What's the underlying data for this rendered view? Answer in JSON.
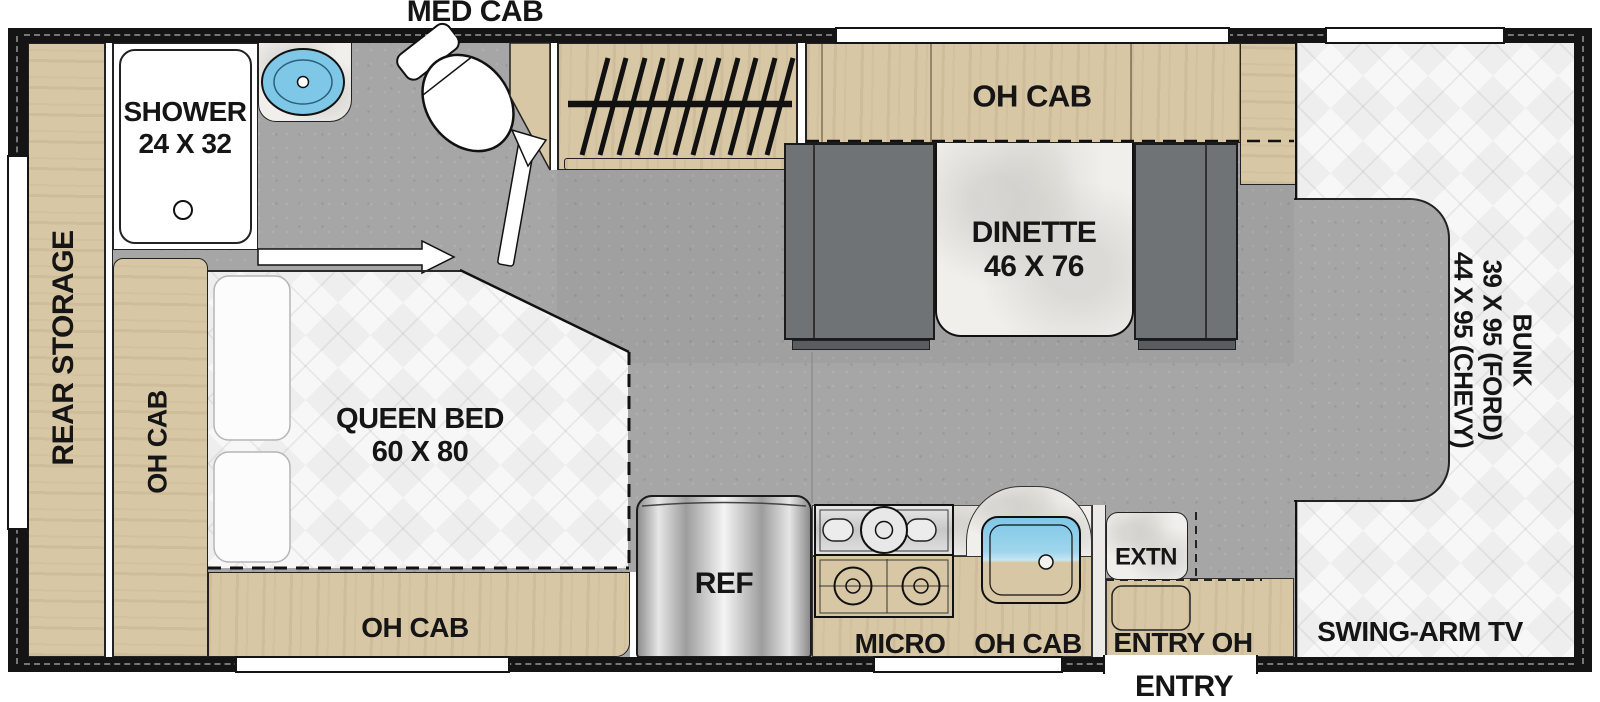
{
  "colors": {
    "wall": "#141414",
    "floor": "#a6a6a6",
    "wood": "#d8c7a5",
    "bench": "#707376",
    "quilt": "#f7f7f7",
    "marble": "#f1efec",
    "sink_blue": "#7fc7e7",
    "text": "#151515"
  },
  "bathroom": {
    "med_cab": "MED CAB",
    "shower_line1": "SHOWER",
    "shower_line2": "24 X 32"
  },
  "storage": {
    "rear_storage": "REAR STORAGE"
  },
  "bedroom": {
    "oh_cab_side": "OH CAB",
    "bed_line1": "QUEEN BED",
    "bed_line2": "60 X 80",
    "oh_cab_bottom": "OH CAB"
  },
  "dinette": {
    "oh_cab": "OH CAB",
    "line1": "DINETTE",
    "line2": "46 X 76"
  },
  "kitchen": {
    "ref": "REF",
    "micro": "MICRO",
    "oh_cab": "OH CAB",
    "extn": "EXTN"
  },
  "entry": {
    "entry_oh": "ENTRY OH",
    "entry": "ENTRY"
  },
  "cab": {
    "bunk_line1": "BUNK",
    "bunk_line2": "39 X 95 (FORD)",
    "bunk_line3": "44 X 95 (CHEVY)",
    "tv": "SWING-ARM TV"
  }
}
